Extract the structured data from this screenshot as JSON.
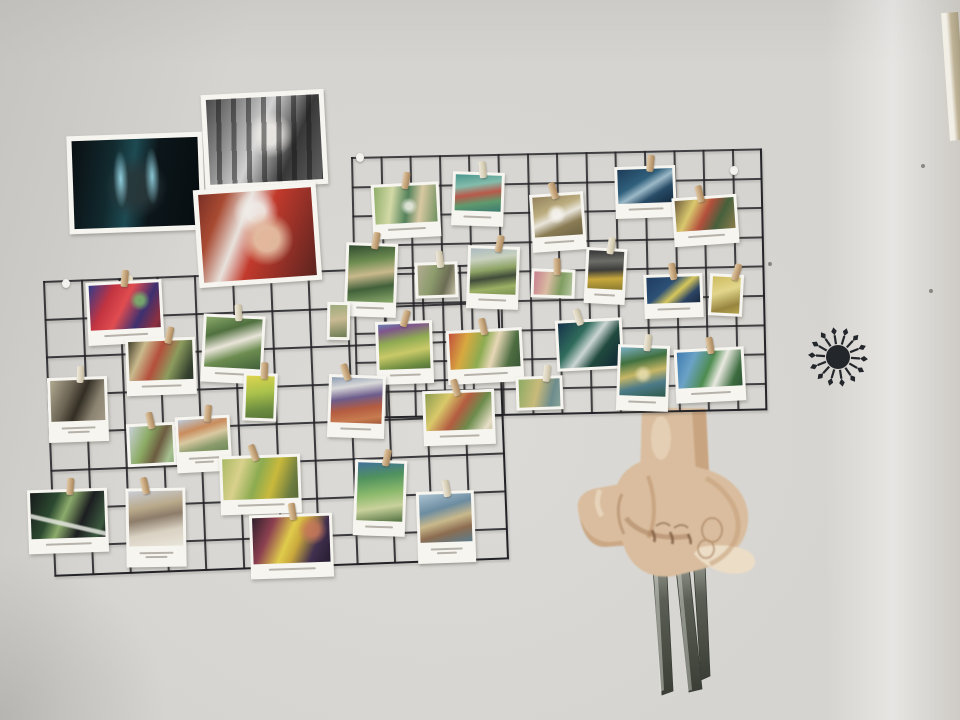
{
  "scene_label": "wall with wire grid panels of clipped postcards, taped movie prints, starburst decal and clawed-hand drawing",
  "wall": {
    "base": "#d6d4d0",
    "corner_strip": {
      "x": 941,
      "y": 12,
      "w": 17,
      "h": 128
    },
    "specks": [
      {
        "x": 921,
        "y": 164
      },
      {
        "x": 929,
        "y": 289
      },
      {
        "x": 768,
        "y": 262
      }
    ]
  },
  "grids": [
    {
      "id": "upper",
      "x": 351,
      "y": 157,
      "w": 409,
      "h": 260,
      "rot": -1.2,
      "cell": 29.3,
      "lw": 2,
      "line": "rgba(32,32,36,0.82)"
    },
    {
      "id": "lower",
      "x": 43,
      "y": 281,
      "w": 453,
      "h": 294,
      "rot": -2.2,
      "cell": 37.8,
      "lw": 2,
      "line": "rgba(32,32,36,0.85)"
    }
  ],
  "hooks": [
    {
      "x": 356,
      "y": 153,
      "tone": "white"
    },
    {
      "x": 62,
      "y": 279,
      "tone": "white"
    },
    {
      "x": 125,
      "y": 275,
      "tone": "cream"
    },
    {
      "x": 730,
      "y": 166,
      "tone": "white"
    }
  ],
  "photos": [
    {
      "id": "dark-movie-still",
      "x": 68,
      "y": 134,
      "w": 126,
      "h": 88,
      "rot": -2,
      "pad": 5,
      "cap": 0,
      "art": {
        "dir": 100,
        "stops": [
          "#0a0f12 0%",
          "#11292e 30%",
          "#1e4a52 46%",
          "#0c161a 62%",
          "#070d10 100%"
        ],
        "overlay": "radial-gradient(ellipse 10% 55% at 38% 45%, rgba(150,215,230,.95), rgba(150,215,230,0) 60%), radial-gradient(ellipse 10% 55% at 63% 43%, rgba(150,215,230,.9), rgba(150,215,230,0) 60%), radial-gradient(circle at 50% 55%, rgba(40,55,58,.9) 0 18%, rgba(40,55,58,0) 40%)"
      }
    },
    {
      "id": "jail-bars-bw",
      "x": 203,
      "y": 92,
      "w": 113,
      "h": 85,
      "rot": -3,
      "pad": 5,
      "cap": 0,
      "art": {
        "dir": 115,
        "stops": [
          "#4a4a4a 0%",
          "#909090 25%",
          "#d2d2d2 45%",
          "#383838 72%",
          "#606060 100%"
        ],
        "overlay": "repeating-linear-gradient(92deg, rgba(25,25,25,0) 0 10px, rgba(22,22,22,.5) 10px 15px), radial-gradient(circle at 55% 45%, rgba(235,232,228,.95) 0 12%, rgba(235,232,228,0) 30%)"
      }
    },
    {
      "id": "red-costume-portrait",
      "x": 196,
      "y": 186,
      "w": 113,
      "h": 88,
      "rot": -4,
      "pad": 5,
      "cap": 0,
      "art": {
        "dir": 115,
        "stops": [
          "#7a3026 0%",
          "#a84a32 18%",
          "#e8e2dc 36%",
          "#c23a2c 52%",
          "#8a2e26 78%",
          "#5a241e 100%"
        ],
        "overlay": "radial-gradient(circle at 58% 55%, rgba(228,190,162,.95) 0 15%, rgba(228,190,162,0) 33%), radial-gradient(circle at 50% 24%, rgba(240,238,234,.9) 0 10%, rgba(240,238,234,0) 26%)"
      }
    }
  ],
  "cards": [
    {
      "id": "u1",
      "x": 372,
      "y": 183,
      "w": 62,
      "h": 49,
      "rot": -3,
      "cap": 1,
      "pin": {
        "dx": -2,
        "rot": 12,
        "tone": "wood"
      },
      "art": {
        "dir": 100,
        "stops": [
          "#8fae6a 0%",
          "#d3d9a6 28%",
          "#53815a 52%",
          "#d8c9a2 72%",
          "#6f9160 100%"
        ],
        "overlay": "radial-gradient(circle at 55% 55%, rgba(240,240,230,.85) 0 8%, rgba(240,240,230,0) 22%)"
      }
    },
    {
      "id": "u2",
      "x": 452,
      "y": 172,
      "w": 46,
      "h": 48,
      "rot": 2,
      "cap": 1,
      "pin": {
        "dx": 0,
        "rot": -8,
        "tone": "cream"
      },
      "art": {
        "dir": 170,
        "stops": [
          "#49958e 0%",
          "#83bcab 30%",
          "#b9594a 52%",
          "#5f9a6d 74%",
          "#3c7a70 100%"
        ]
      }
    },
    {
      "id": "u3",
      "x": 531,
      "y": 193,
      "w": 48,
      "h": 52,
      "rot": -4,
      "cap": 1,
      "pin": {
        "dx": -6,
        "rot": -14,
        "tone": "wood"
      },
      "art": {
        "dir": 160,
        "stops": [
          "#93815c 0%",
          "#bcae80 35%",
          "#e9e5db 52%",
          "#8a7c54 72%",
          "#6e6344 100%"
        ],
        "overlay": "radial-gradient(circle at 48% 45%, rgba(245,243,238,.9) 0 12%, rgba(245,243,238,0) 30%)"
      }
    },
    {
      "id": "u4",
      "x": 615,
      "y": 166,
      "w": 55,
      "h": 46,
      "rot": -2,
      "cap": 1,
      "pin": {
        "dx": 2,
        "rot": 8,
        "tone": "wood"
      },
      "art": {
        "dir": 150,
        "stops": [
          "#1d3c58 0%",
          "#2f5f7c 38%",
          "#9cb9c8 54%",
          "#274b66 72%",
          "#152a40 100%"
        ]
      }
    },
    {
      "id": "u5",
      "x": 673,
      "y": 196,
      "w": 59,
      "h": 43,
      "rot": -4,
      "cap": 1,
      "pin": {
        "dx": -8,
        "rot": -10,
        "tone": "wood"
      },
      "art": {
        "dir": 120,
        "stops": [
          "#6e5c3c 0%",
          "#d9c86e 28%",
          "#b44f3c 50%",
          "#46603c 72%",
          "#8c7c4c 100%"
        ]
      }
    },
    {
      "id": "u6",
      "x": 709,
      "y": 274,
      "w": 28,
      "h": 36,
      "rot": 3,
      "cap": 0,
      "pin": {
        "dx": 6,
        "rot": 14,
        "tone": "wood"
      },
      "art": {
        "dir": 160,
        "stops": [
          "#cdbb5e 0%",
          "#e2d68c 40%",
          "#97853f 78%",
          "#b5a34e 100%"
        ]
      }
    },
    {
      "id": "u7",
      "x": 585,
      "y": 248,
      "w": 35,
      "h": 50,
      "rot": 3,
      "cap": 1,
      "pin": {
        "dx": 0,
        "rot": 6,
        "tone": "cream"
      },
      "art": {
        "dir": 175,
        "stops": [
          "#343436 0%",
          "#6d6d68 28%",
          "#3c3c3a 50%",
          "#c8a83c 72%",
          "#8a7a30 100%"
        ]
      }
    },
    {
      "id": "u8",
      "x": 644,
      "y": 274,
      "w": 53,
      "h": 38,
      "rot": -2,
      "cap": 1,
      "pin": {
        "dx": -4,
        "rot": -8,
        "tone": "wood"
      },
      "art": {
        "dir": 140,
        "stops": [
          "#203c60 0%",
          "#2c5076 38%",
          "#d7c75c 58%",
          "#2c4464 78%",
          "#18293f 100%"
        ]
      }
    },
    {
      "id": "u9",
      "x": 556,
      "y": 319,
      "w": 61,
      "h": 45,
      "rot": -3,
      "cap": 0,
      "pin": {
        "dx": -14,
        "rot": -16,
        "tone": "cream"
      },
      "art": {
        "dir": 130,
        "stops": [
          "#17334b 0%",
          "#2f6b5b 32%",
          "#ccd6d4 50%",
          "#20493d 68%",
          "#102535 100%"
        ]
      }
    },
    {
      "id": "u10",
      "x": 617,
      "y": 345,
      "w": 46,
      "h": 60,
      "rot": 2,
      "cap": 1,
      "pin": {
        "dx": 0,
        "rot": 4,
        "tone": "cream"
      },
      "art": {
        "dir": 165,
        "stops": [
          "#7cb0c6 0%",
          "#41703f 28%",
          "#c7b766 52%",
          "#4c7a88 74%",
          "#2f5a4b 100%"
        ],
        "overlay": "radial-gradient(circle at 50% 55%, rgba(235,225,180,.8) 0 10%, rgba(235,225,180,0) 26%)"
      }
    },
    {
      "id": "u11",
      "x": 675,
      "y": 348,
      "w": 64,
      "h": 48,
      "rot": -3,
      "cap": 1,
      "pin": {
        "dx": -2,
        "rot": -6,
        "tone": "wood"
      },
      "art": {
        "dir": 115,
        "stops": [
          "#3f7cb0 0%",
          "#6ba2c6 24%",
          "#4e8c50 48%",
          "#e9e9e0 64%",
          "#3d6c40 86%",
          "#2e5434 100%"
        ]
      }
    },
    {
      "id": "u12",
      "x": 467,
      "y": 246,
      "w": 46,
      "h": 57,
      "rot": 2,
      "cap": 1,
      "pin": {
        "dx": 2,
        "rot": 10,
        "tone": "wood"
      },
      "art": {
        "dir": 170,
        "stops": [
          "#aab9bf 0%",
          "#c9d1bf 24%",
          "#8ca263 46%",
          "#414c3a 62%",
          "#9cb164 82%",
          "#7a9050 100%"
        ]
      }
    },
    {
      "id": "u13",
      "x": 531,
      "y": 269,
      "w": 38,
      "h": 23,
      "rot": 2,
      "cap": 0,
      "pin": {
        "dx": 0,
        "rot": -4,
        "tone": "wood"
      },
      "art": {
        "dir": 100,
        "stops": [
          "#c8808e 0%",
          "#d9bba2 38%",
          "#7f9d60 70%",
          "#b7c6a0 100%"
        ]
      }
    },
    {
      "id": "m1",
      "x": 376,
      "y": 321,
      "w": 51,
      "h": 57,
      "rot": -2,
      "cap": 1,
      "pin": {
        "dx": -2,
        "rot": 18,
        "tone": "wood"
      },
      "art": {
        "dir": 170,
        "stops": [
          "#6b80b2 0%",
          "#7e558c 14%",
          "#8fab52 38%",
          "#c9c968 62%",
          "#6d8c40 88%",
          "#55703a 100%"
        ]
      }
    },
    {
      "id": "m2",
      "x": 447,
      "y": 329,
      "w": 70,
      "h": 48,
      "rot": -3,
      "cap": 1,
      "pin": {
        "dx": -4,
        "rot": -10,
        "tone": "wood"
      },
      "art": {
        "dir": 110,
        "stops": [
          "#c2503c 0%",
          "#d8a940 24%",
          "#8cab50 46%",
          "#e7d7b6 62%",
          "#4c6c40 84%",
          "#3c5838 100%"
        ]
      }
    },
    {
      "id": "m3",
      "x": 423,
      "y": 390,
      "w": 66,
      "h": 49,
      "rot": -2,
      "cap": 1,
      "pin": {
        "dx": -6,
        "rot": -14,
        "tone": "wood"
      },
      "art": {
        "dir": 125,
        "stops": [
          "#8c9c50 0%",
          "#d9c96a 28%",
          "#b45c40 50%",
          "#6c8c4c 70%",
          "#e7dfc7 92%",
          "#cfc7a8 100%"
        ]
      }
    },
    {
      "id": "m4",
      "x": 516,
      "y": 376,
      "w": 41,
      "h": 28,
      "rot": -2,
      "cap": 0,
      "pin": {
        "dx": 4,
        "rot": 8,
        "tone": "cream"
      },
      "art": {
        "dir": 105,
        "stops": [
          "#8cab64 0%",
          "#c9ba7a 44%",
          "#6c8c8c 78%",
          "#8aa39a 100%"
        ]
      }
    },
    {
      "id": "m5",
      "x": 328,
      "y": 375,
      "w": 51,
      "h": 57,
      "rot": 2,
      "cap": 1,
      "pin": {
        "dx": -16,
        "rot": -20,
        "tone": "wood"
      },
      "art": {
        "dir": 170,
        "stops": [
          "#8c9cb2 0%",
          "#d9d9d9 22%",
          "#6c5c8c 44%",
          "#b45c40 66%",
          "#c87c50 86%",
          "#a05838 100%"
        ]
      }
    },
    {
      "id": "l1",
      "x": 87,
      "y": 281,
      "w": 70,
      "h": 57,
      "rot": -3,
      "cap": 1,
      "pin": {
        "dx": -2,
        "rot": 8,
        "tone": "wood"
      },
      "art": {
        "dir": 120,
        "stops": [
          "#303c8c 0%",
          "#c23440 28%",
          "#e04c50 48%",
          "#3c3070 72%",
          "#8c3040 92%",
          "#6a2838 100%"
        ],
        "overlay": "radial-gradient(circle at 72% 38%, rgba(120,190,110,.8) 0 7%, rgba(120,190,110,0) 18%)"
      }
    },
    {
      "id": "l2",
      "x": 126,
      "y": 338,
      "w": 64,
      "h": 51,
      "rot": -2,
      "cap": 1,
      "pin": {
        "dx": 6,
        "rot": 14,
        "tone": "wood"
      },
      "art": {
        "dir": 115,
        "stops": [
          "#44402e 0%",
          "#c9b98c 22%",
          "#b44f3c 44%",
          "#8c9c5e 66%",
          "#35412e 90%",
          "#2c382a 100%"
        ]
      }
    },
    {
      "id": "l3",
      "x": 202,
      "y": 315,
      "w": 56,
      "h": 62,
      "rot": 3,
      "cap": 1,
      "pin": {
        "dx": 0,
        "rot": -6,
        "tone": "cream"
      },
      "art": {
        "dir": 160,
        "stops": [
          "#8cab6c 0%",
          "#50703f 28%",
          "#e9e5d9 50%",
          "#6c8c50 70%",
          "#41603a 100%"
        ]
      }
    },
    {
      "id": "l4",
      "x": 48,
      "y": 377,
      "w": 54,
      "h": 59,
      "rot": -2,
      "cap": 2,
      "pin": {
        "dx": 0,
        "rot": 4,
        "tone": "cream"
      },
      "art": {
        "dir": 115,
        "stops": [
          "#b2ab92 0%",
          "#6c6454 34%",
          "#332e24 54%",
          "#8c8472 78%",
          "#a29a86 100%"
        ]
      }
    },
    {
      "id": "l5",
      "x": 127,
      "y": 423,
      "w": 43,
      "h": 37,
      "rot": -3,
      "cap": 0,
      "pin": {
        "dx": -4,
        "rot": -10,
        "tone": "wood"
      },
      "art": {
        "dir": 115,
        "stops": [
          "#c9d1d9 0%",
          "#8cab64 38%",
          "#6c5c40 64%",
          "#a8c292 88%",
          "#90ad7c 100%"
        ]
      }
    },
    {
      "id": "l6",
      "x": 176,
      "y": 416,
      "w": 49,
      "h": 50,
      "rot": -3,
      "cap": 2,
      "pin": {
        "dx": 2,
        "rot": 8,
        "tone": "wood"
      },
      "art": {
        "dir": 165,
        "stops": [
          "#b9c9d9 0%",
          "#c98c5c 32%",
          "#d9c9a2 54%",
          "#8c9c6c 78%",
          "#70895a 100%"
        ]
      }
    },
    {
      "id": "l7",
      "x": 220,
      "y": 455,
      "w": 75,
      "h": 53,
      "rot": -2,
      "cap": 1,
      "pin": {
        "dx": -10,
        "rot": -18,
        "tone": "wood"
      },
      "art": {
        "dir": 110,
        "stops": [
          "#aab964 0%",
          "#d9d18c 24%",
          "#8cab50 46%",
          "#c9b93c 66%",
          "#6c7c40 88%",
          "#5a6a38 100%"
        ]
      }
    },
    {
      "id": "l8",
      "x": 126,
      "y": 488,
      "w": 54,
      "h": 73,
      "rot": -1,
      "cap": 2,
      "pin": {
        "dx": -14,
        "rot": -12,
        "tone": "wood"
      },
      "art": {
        "dir": 170,
        "stops": [
          "#c9ccd4 0%",
          "#b9a98a 30%",
          "#8c7c6a 48%",
          "#d9d1c2 72%",
          "#e9e5da 100%"
        ]
      }
    },
    {
      "id": "l9",
      "x": 28,
      "y": 489,
      "w": 74,
      "h": 58,
      "rot": -2,
      "cap": 1,
      "pin": {
        "dx": 0,
        "rot": 6,
        "tone": "wood"
      },
      "art": {
        "dir": 115,
        "stops": [
          "#17191b 0%",
          "#2c4a30 30%",
          "#8cab6c 46%",
          "#1c1e20 68%",
          "#3c5a40 90%",
          "#141618 100%"
        ],
        "overlay": "linear-gradient(15deg, rgba(228,230,222,0) 30%, rgba(228,230,222,.85) 33% 37%, rgba(228,230,222,0) 40%)"
      }
    },
    {
      "id": "l10",
      "x": 250,
      "y": 514,
      "w": 77,
      "h": 58,
      "rot": -2,
      "cap": 1,
      "pin": {
        "dx": -2,
        "rot": -6,
        "tone": "wood"
      },
      "art": {
        "dir": 115,
        "stops": [
          "#30202c 0%",
          "#8c4050 24%",
          "#e0cc4c 46%",
          "#c9a83c 58%",
          "#41304f 78%",
          "#241c30 100%"
        ],
        "overlay": "radial-gradient(circle at 78% 30%, rgba(200,120,90,.85) 0 9%, rgba(200,120,90,0) 22%)"
      }
    },
    {
      "id": "l11",
      "x": 354,
      "y": 460,
      "w": 46,
      "h": 70,
      "rot": 2,
      "cap": 1,
      "pin": {
        "dx": 2,
        "rot": 10,
        "tone": "wood"
      },
      "art": {
        "dir": 170,
        "stops": [
          "#41709c 0%",
          "#50925e 26%",
          "#8cba6c 52%",
          "#c9d19c 74%",
          "#50703f 100%"
        ]
      }
    },
    {
      "id": "l12",
      "x": 417,
      "y": 491,
      "w": 52,
      "h": 66,
      "rot": -2,
      "cap": 2,
      "pin": {
        "dx": -2,
        "rot": -8,
        "tone": "cream"
      },
      "art": {
        "dir": 165,
        "stops": [
          "#aac2d1 0%",
          "#6c8ca0 32%",
          "#c9b98c 54%",
          "#8c6c50 74%",
          "#5c7c8c 100%"
        ]
      }
    },
    {
      "id": "l13",
      "x": 345,
      "y": 243,
      "w": 46,
      "h": 68,
      "rot": 2,
      "cap": 1,
      "pin": {
        "dx": 0,
        "rot": 8,
        "tone": "wood"
      },
      "art": {
        "dir": 170,
        "stops": [
          "#304a30 0%",
          "#6c8c50 28%",
          "#c9b98c 50%",
          "#41603a 72%",
          "#8cab6c 100%"
        ]
      }
    },
    {
      "id": "l14",
      "x": 415,
      "y": 262,
      "w": 37,
      "h": 30,
      "rot": -2,
      "cap": 0,
      "pin": {
        "dx": 0,
        "rot": -4,
        "tone": "cream"
      },
      "art": {
        "dir": 110,
        "stops": [
          "#b2ab92 0%",
          "#8c9c6c 40%",
          "#6c6c54 72%",
          "#c9c2aa 100%"
        ]
      }
    },
    {
      "id": "l15",
      "x": 243,
      "y": 373,
      "w": 28,
      "h": 42,
      "rot": 2,
      "cap": 0,
      "pin": {
        "dx": 0,
        "rot": 0,
        "tone": "wood"
      },
      "art": {
        "dir": 170,
        "stops": [
          "#ddd44e 0%",
          "#aac24c 40%",
          "#6c8c40 78%",
          "#5a7838 100%"
        ]
      }
    },
    {
      "id": "l16",
      "x": 327,
      "y": 302,
      "w": 17,
      "h": 32,
      "rot": 1,
      "cap": 0,
      "pin": null,
      "art": {
        "dir": 170,
        "stops": [
          "#9cab7c 0%",
          "#c9ba92 45%",
          "#6c7c54 100%"
        ]
      }
    }
  ],
  "starburst": {
    "cx": 838,
    "cy": 357,
    "color": "#23262b",
    "spokes": 14,
    "inner_r": 12,
    "spoke_start": 13,
    "spoke_end": 22,
    "tip_out": 30,
    "tip_half": 2.8,
    "angle_offset": 4
  },
  "hand": {
    "x": 556,
    "y": 398,
    "w": 215,
    "h": 300,
    "skin_base": "#d9bd9e",
    "skin_mid": "#c49e78",
    "skin_shadow": "#a57c58",
    "skin_line": "#7e5a40",
    "skin_pale": "#ecddc6",
    "claw_light": "#b9bdb2",
    "claw_mid": "#5a5e54",
    "claw_dark": "#3a3e36"
  }
}
